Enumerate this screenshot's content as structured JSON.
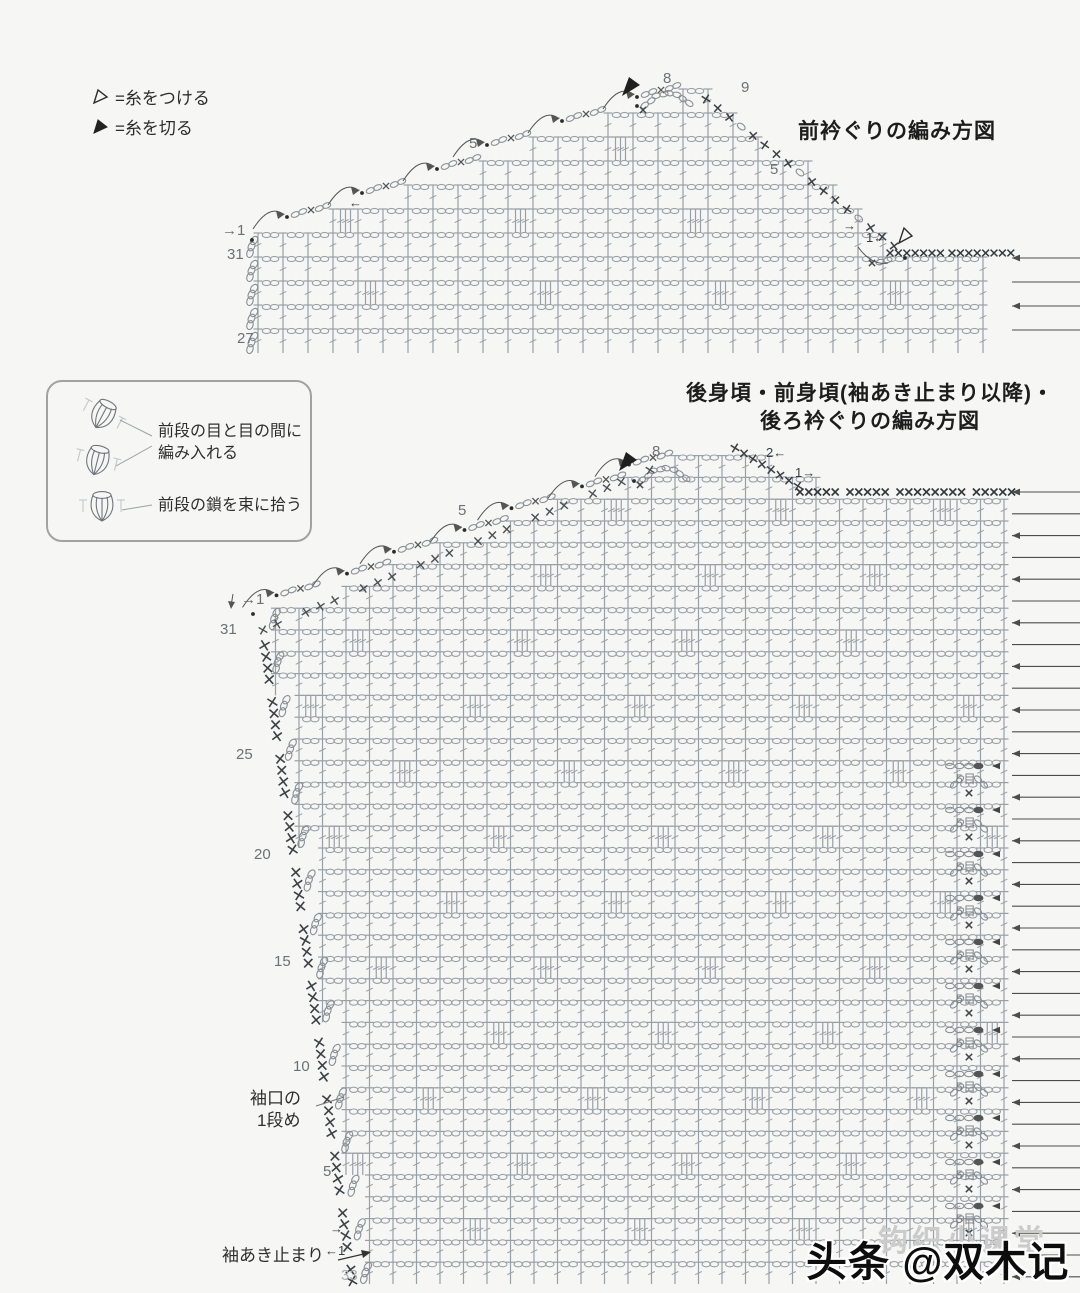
{
  "page": {
    "width": 1080,
    "height": 1293
  },
  "symbols_legend": {
    "attach": {
      "icon": "open-triangle",
      "label": "=糸をつける"
    },
    "cut": {
      "icon": "filled-triangle",
      "label": "=糸を切る"
    }
  },
  "stitch_legend_box": {
    "caption_between_line1": "前段の目と目の間に",
    "caption_between_line2": "編み入れる",
    "caption_bundle": "前段の鎖を束に拾う"
  },
  "chart_front_neck": {
    "title": "前衿ぐりの編み方図",
    "labels": {
      "row_start": "→1",
      "row_31": "31",
      "row_27": "27",
      "peak": "8",
      "neck_top": "9",
      "step_count": "5",
      "neck_mid": "5",
      "turn_left": "←",
      "turn_right": "→",
      "row_1_left": "1←"
    },
    "right_arrow_rows": 4
  },
  "chart_body": {
    "title_line1": "後身頃・前身頃(袖あき止まり以降)・",
    "title_line2": "後ろ衿ぐりの編み方図",
    "labels": {
      "row_start": "→1",
      "row_31": "31",
      "row_25": "25",
      "row_20": "20",
      "row_15": "15",
      "row_10": "10",
      "row_5": "5",
      "row_33": "33",
      "peak": "8",
      "step_count": "5",
      "row_2_left": "2←",
      "row_1_right": "1→",
      "row_1_left": "←1",
      "turn_right": "→",
      "cuff_line1": "袖口の",
      "cuff_line2": "1段め",
      "armhole_stop": "袖あき止まり",
      "five_stitches": "5目"
    },
    "five_stitch_loop_count": 11,
    "right_arrow_rows": 37
  },
  "watermark": {
    "faint": "钩织小课堂",
    "main": "头条 @双木记编织"
  },
  "colors": {
    "symbol": "#98a0a7",
    "symbol_dark": "#868e95",
    "dark_mark": "#41474d",
    "arrow": "#4d4d4d",
    "label": "#2e2e2e",
    "row_number": "#6c7176"
  }
}
